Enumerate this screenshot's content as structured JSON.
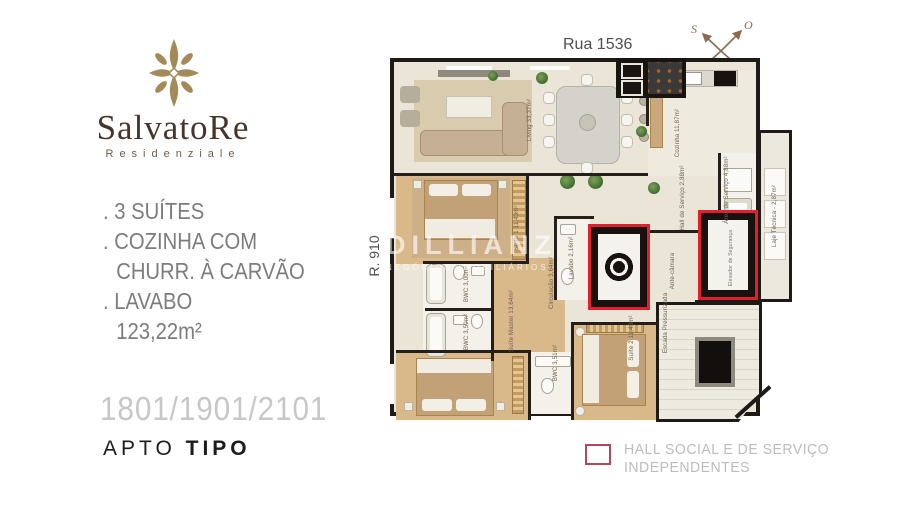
{
  "branding": {
    "name": "SalvatoRe",
    "subtitle": "Residenziale"
  },
  "features": {
    "lines": [
      ". 3 SUÍTES",
      ". COZINHA COM",
      "CHURR. À CARVÃO",
      ". LAVABO",
      "123,22m²"
    ]
  },
  "apartment": {
    "units": "1801/1901/2101",
    "label": "APTO",
    "label_bold": "TIPO"
  },
  "streets": {
    "top": "Rua 1536",
    "left": "R. 910"
  },
  "compass": {
    "nw": "S",
    "ne": "O",
    "sw": "L",
    "se": "N"
  },
  "watermark": {
    "title": "DILLIANZ",
    "subtitle": "NEGÓCIOS IMOBILIÁRIOS"
  },
  "legend": {
    "line1": "HALL SOCIAL E DE SERVIÇO",
    "line2": "INDEPENDENTES"
  },
  "rooms": {
    "living": "Living 33,37m²",
    "cozinha": "Cozinha 11,87m²",
    "area_servico": "Área de Serviço 4,88m²",
    "hall_servico": "Hall de Serviço 2,88m²",
    "lavabo": "Lavabo 2,16m²",
    "ante_camara": "Ante-câmara",
    "escada": "Escada Pressurizada",
    "laje_tecnica": "Laje Técnica - 2,87m²",
    "elevador_seguranca": "Elevador de Segurança",
    "suite1": "Suíte 1 11,43m²",
    "bwc1": "BWC 3,00m²",
    "bwc2": "BWC 3,50m²",
    "circulacao": "Circulação 3,64m²",
    "suite_master": "Suíte Master 13,64m²",
    "bwc3": "BWC 3,51m²",
    "suite2": "Suíte 2 11,43m²"
  },
  "colors": {
    "accent_red": "#e31e2d",
    "legend_red": "#b5455f",
    "gold": "#a38a58",
    "brand_brown": "#46352a"
  }
}
